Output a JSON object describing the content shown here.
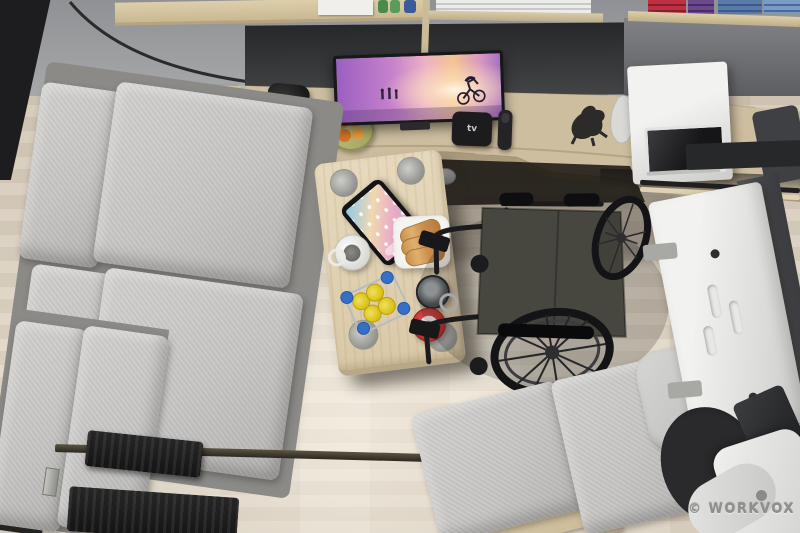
{
  "meta": {
    "kind": "3d-render-photo",
    "description": "Top-down 3D render of a wheelchair-accessible camper van interior",
    "width": 800,
    "height": 533
  },
  "watermark": {
    "text": "© WORKVOX"
  },
  "palette": {
    "floor_wood": "#d8cdbc",
    "counter_wood": "#cdbea0",
    "table_wood": "#e2d4b6",
    "wall_gray": "#96989b",
    "wall_dark_band": "#2c2d2f",
    "sofa_gray": "#c8c7c5",
    "wheelchair_frame": "#1b1b1d",
    "wheelchair_seat": "#47473f",
    "microwave_white": "#ededeb",
    "machine_white": "#e9e9e7",
    "tv_purple": "#9a5fc0",
    "tv_pink": "#eeb2c4",
    "tv_orange": "#f3c491",
    "red_mug": "#c43232",
    "yellow_cups": "#e6cf2a",
    "blue_caps": "#3570c8",
    "mat_black": "#1e1e1e"
  },
  "objects": {
    "walls": {
      "label": "gray van walls with window trim"
    },
    "shelf_left": {
      "label": "open wood shelf with white box, green bottles, blue can"
    },
    "shelf_towels": {
      "label": "shelf with folded white towels"
    },
    "shelf_clothes": {
      "label": "shelf with folded red, purple and blue clothes"
    },
    "counter": {
      "label": "curved wooden kitchenette counter / desk"
    },
    "sink": {
      "label": "stainless steel sink with faucet"
    },
    "coffee_machine": {
      "label": "black water/coffee dispenser"
    },
    "dish_tray": {
      "label": "gray perforated dish tray"
    },
    "fruit_bowl": {
      "label": "bowl of oranges plus one loose orange"
    },
    "tv": {
      "label": "wall TV showing beach sunset with cyclist silhouette"
    },
    "apple_tv": {
      "label": "black media box",
      "logo": "tv"
    },
    "remote": {
      "label": "black remote control"
    },
    "figurines": {
      "label": "dark and white animal figurines"
    },
    "microwave": {
      "label": "white microwave with dark glass door"
    },
    "sofa": {
      "label": "L-shaped light gray sofa bench"
    },
    "black_step": {
      "label": "black step/tray at sofa edge"
    },
    "black_mat": {
      "label": "black ribbed floor mat"
    },
    "floor_rail": {
      "label": "floor mounting rail track"
    },
    "table": {
      "label": "wooden dinette table with cup-holder recesses"
    },
    "tablet": {
      "label": "tablet with colorful home screen"
    },
    "white_mug": {
      "label": "white mug"
    },
    "croissant_plate": {
      "label": "white plate with croissants"
    },
    "drink_caddy": {
      "label": "wire caddy with yellow cups and blue-cap bottles"
    },
    "metal_mug": {
      "label": "stainless travel mug"
    },
    "red_mug": {
      "label": "red mug with white lid"
    },
    "wheelchair": {
      "label": "black manual wheelchair with spoked wheels"
    },
    "accent_seat": {
      "label": "single gray lounge seat on wood base"
    },
    "lift_machine": {
      "label": "white folded lift/ramp machine on right wall"
    },
    "scooter": {
      "label": "white mobility device with black wheel, bottom right"
    }
  }
}
